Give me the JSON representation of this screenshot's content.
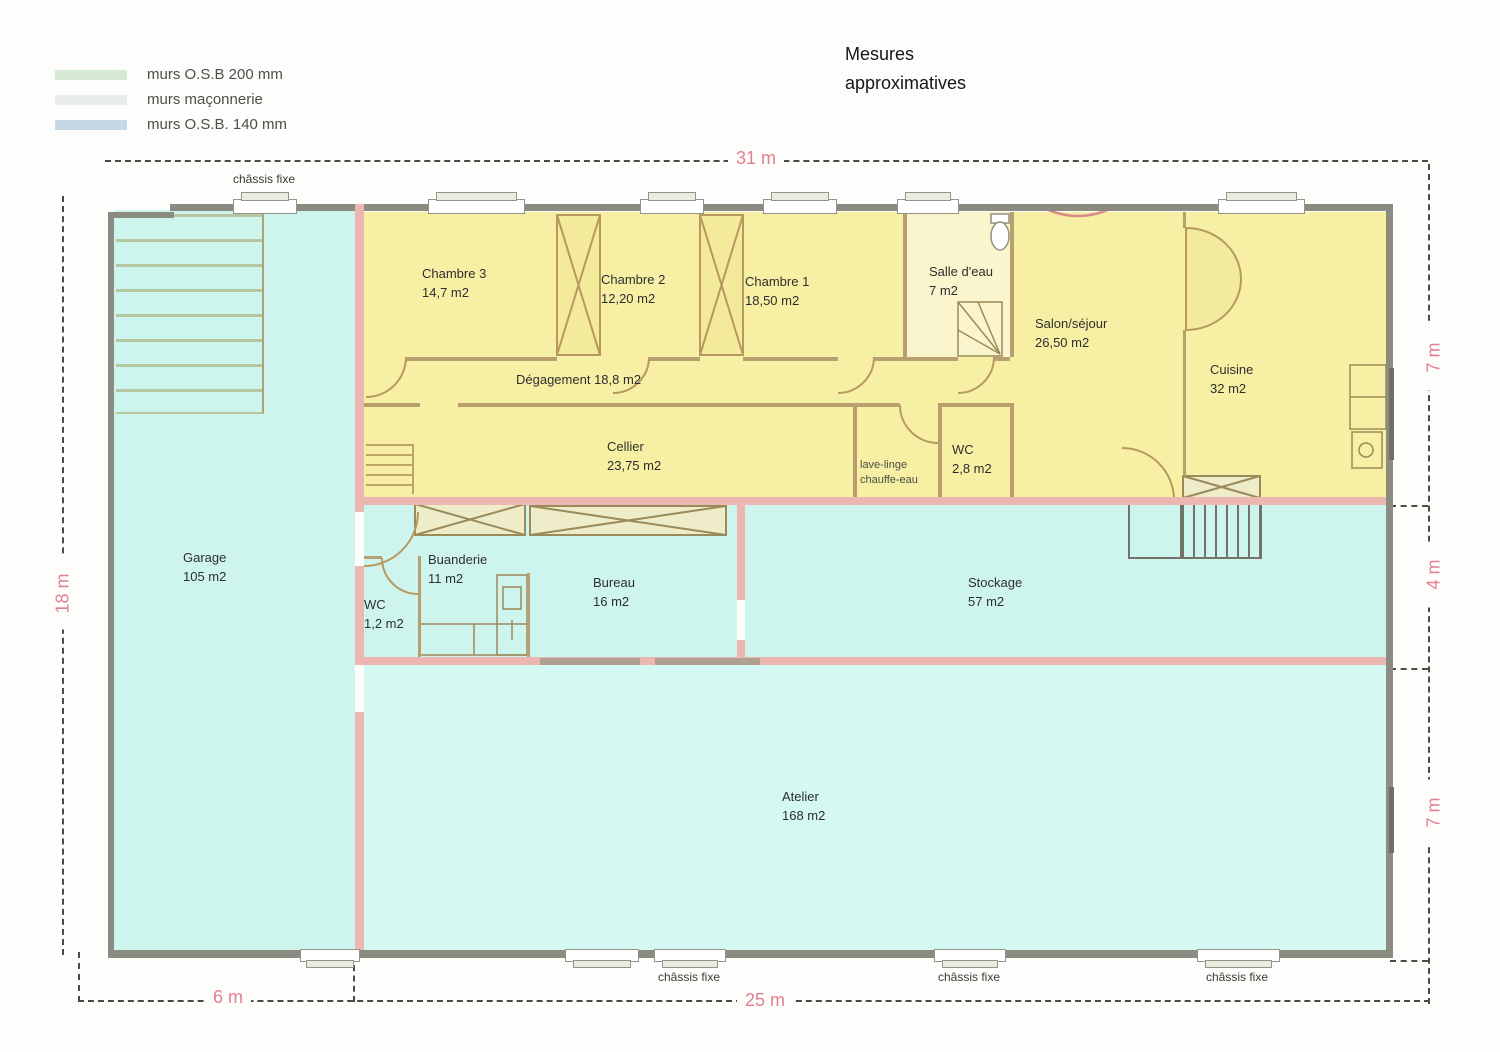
{
  "title": {
    "line1": "Mesures",
    "line2": "approximatives"
  },
  "legend": {
    "items": [
      {
        "label": "murs O.S.B 200 mm",
        "color": "#d6e9d2"
      },
      {
        "label": "murs maçonnerie",
        "color": "#e9edea"
      },
      {
        "label": "murs O.S.B. 140 mm",
        "color": "#c6d8e5"
      }
    ]
  },
  "dimensions": {
    "top": "31 m",
    "left": "18 m",
    "right_top": "7 m",
    "right_middle": "4 m",
    "right_bottom": "7 m",
    "bottom_left": "6 m",
    "bottom_right": "25 m"
  },
  "window_label": "châssis fixe",
  "rooms": {
    "chambre3": {
      "name": "Chambre 3",
      "area": "14,7 m2"
    },
    "chambre2": {
      "name": "Chambre 2",
      "area": "12,20 m2"
    },
    "chambre1": {
      "name": "Chambre 1",
      "area": "18,50 m2"
    },
    "salle_eau": {
      "name": "Salle d'eau",
      "area": "7 m2"
    },
    "salon": {
      "name": "Salon/séjour",
      "area": "26,50 m2"
    },
    "cuisine": {
      "name": "Cuisine",
      "area": "32 m2"
    },
    "degagement": {
      "name": "Dégagement",
      "area": "18,8 m2"
    },
    "cellier": {
      "name": "Cellier",
      "area": "23,75 m2"
    },
    "lave_linge": {
      "line1": "lave-linge",
      "line2": "chauffe-eau"
    },
    "wc_haut": {
      "name": "WC",
      "area": "2,8 m2"
    },
    "garage": {
      "name": "Garage",
      "area": "105 m2"
    },
    "wc_bas": {
      "name": "WC",
      "area": "1,2 m2"
    },
    "buanderie": {
      "name": "Buanderie",
      "area": "11 m2"
    },
    "bureau": {
      "name": "Bureau",
      "area": "16 m2"
    },
    "stockage": {
      "name": "Stockage",
      "area": "57 m2"
    },
    "atelier": {
      "name": "Atelier",
      "area": "168 m2"
    }
  },
  "colors": {
    "osb_rooms": "#f7f0a4",
    "masonry_rooms": "#cdf5ee",
    "wall_pink": "#ecb7b1",
    "wall_gray": "#8b8b82",
    "wall_tan": "#b89f6d",
    "dimension_text": "#e2818e"
  }
}
